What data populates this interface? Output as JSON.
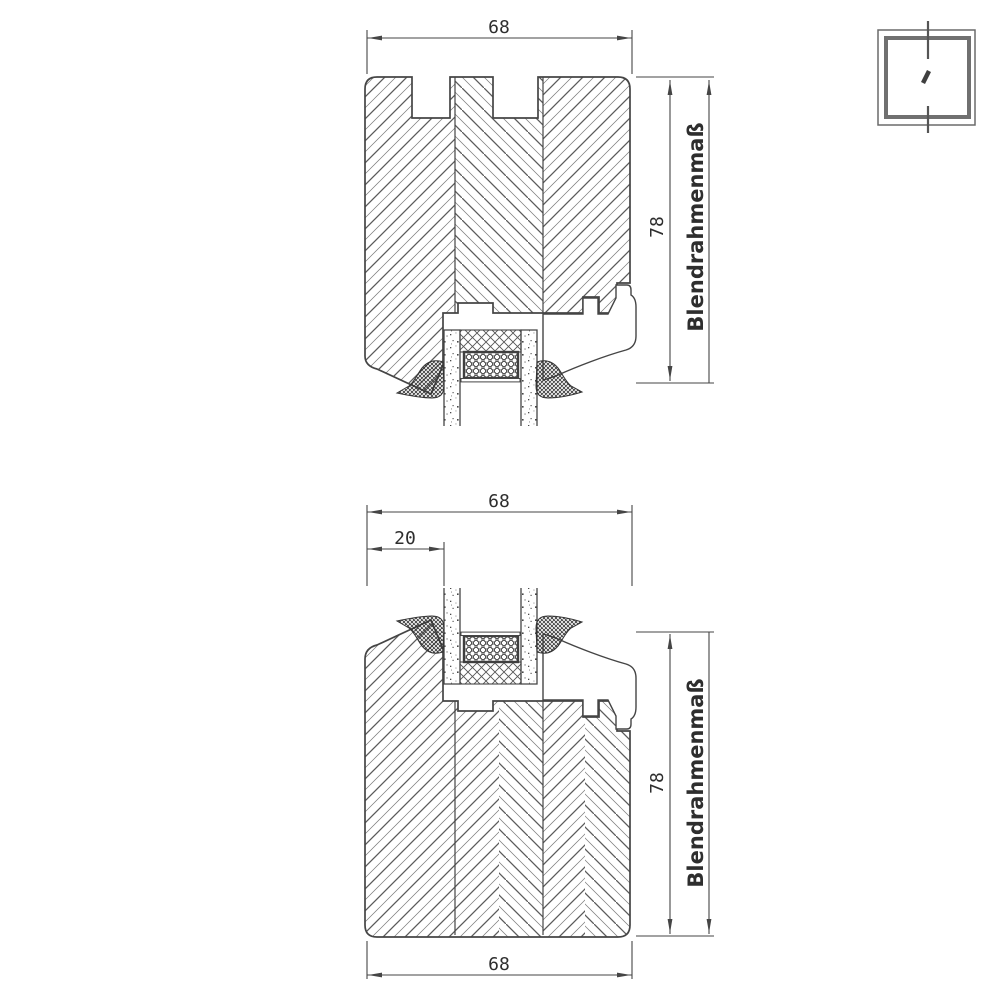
{
  "drawing": {
    "type": "technical-section-drawing",
    "background": "#ffffff",
    "line_color": "#454545",
    "hatch_color": "#5a5a5a",
    "top_section": {
      "width_dim": "68",
      "height_dim": "78",
      "height_label": "Blendrahmenmaß"
    },
    "bottom_section": {
      "top_width_dim": "68",
      "glass_offset_dim": "20",
      "height_dim": "78",
      "height_label": "Blendrahmenmaß",
      "bottom_width_dim": "68"
    },
    "corner_icon": "window-section-indicator"
  }
}
